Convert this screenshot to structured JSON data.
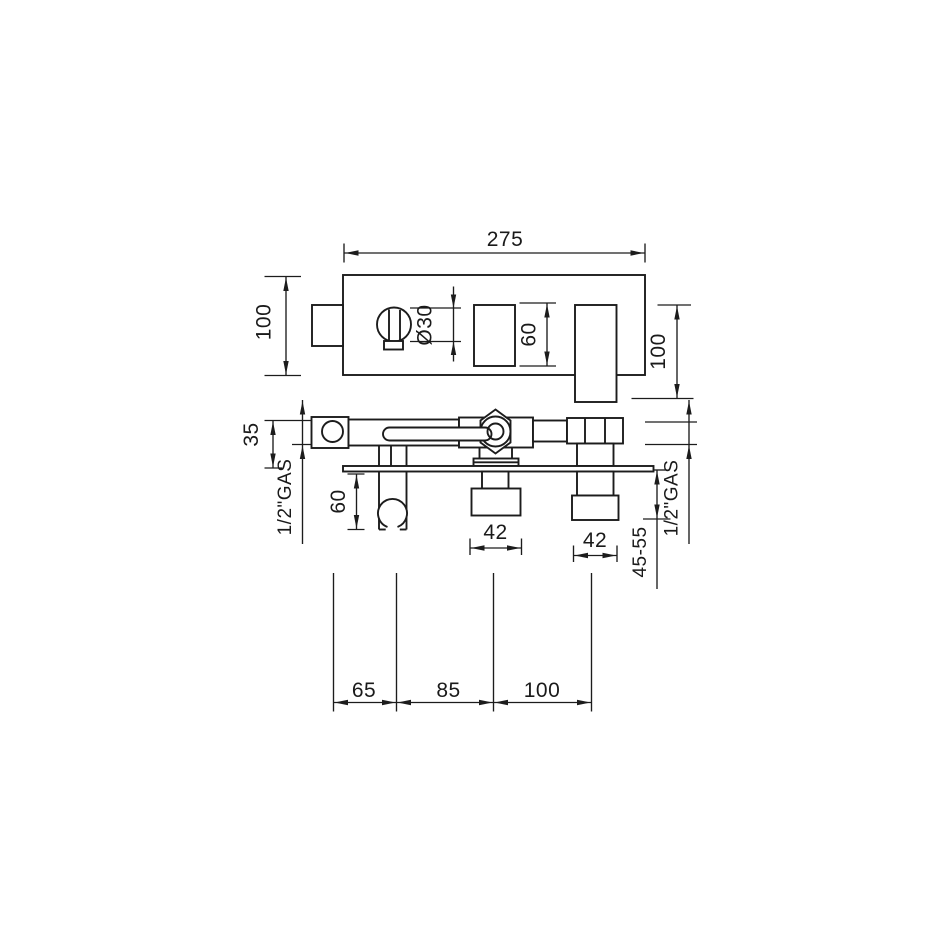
{
  "drawing": {
    "top_view": {
      "overall_width": "275",
      "depth_left": "100",
      "knob_diameter": "Ø30",
      "cutout_height": "60",
      "spout_length": "100"
    },
    "front_view": {
      "body_height": "35",
      "thread_left": "1/2\"GAS",
      "holder_depth": "60",
      "outlet_center_width": "42",
      "outlet_right_width": "42",
      "tail_length_range": "45-55",
      "thread_right": "1/2\"GAS"
    },
    "spacing": {
      "span_1": "65",
      "span_2": "85",
      "span_3": "100"
    }
  }
}
